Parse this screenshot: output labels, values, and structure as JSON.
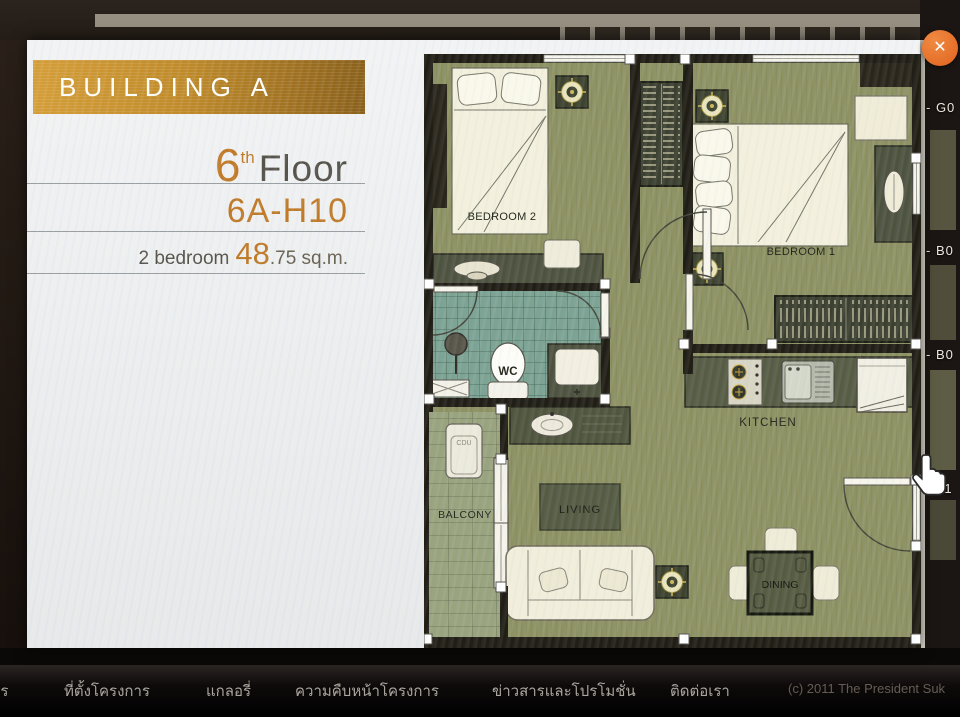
{
  "popup": {
    "banner_title": "BUILDING A",
    "floor": {
      "number": "6",
      "suffix": "th",
      "word": "Floor"
    },
    "unit_code": "6A-H10",
    "spec": {
      "bedrooms": "2 bedroom",
      "area_int": "48",
      "area_frac": ".75",
      "area_unit": "sq.m."
    },
    "close_icon": "✕"
  },
  "floorplan": {
    "labels": {
      "bedroom1": "BEDROOM 1",
      "bedroom2": "BEDROOM 2",
      "wc": "WC",
      "kitchen": "KITCHEN",
      "living": "LIVING",
      "dining": "DINING",
      "balcony": "BALCONY",
      "cdu": "CDU"
    }
  },
  "background": {
    "unit_tags": [
      "- G0",
      "- B0",
      "- B0",
      "H1"
    ]
  },
  "nav": {
    "items": [
      "าร",
      "ที่ตั้งโครงการ",
      "แกลอรี่",
      "ความคืบหน้าโครงการ",
      "ข่าวสารและโปรโมชั่น",
      "ติดต่อเรา"
    ],
    "copyright": "(c) 2011 The President Suk"
  },
  "colors": {
    "accent_orange": "#c07a28",
    "banner_gold": "#c08a28",
    "close_orange": "#e0631e",
    "floor_green": "#8f9364",
    "tile_teal": "#7da394",
    "wall_black": "#211e16"
  }
}
